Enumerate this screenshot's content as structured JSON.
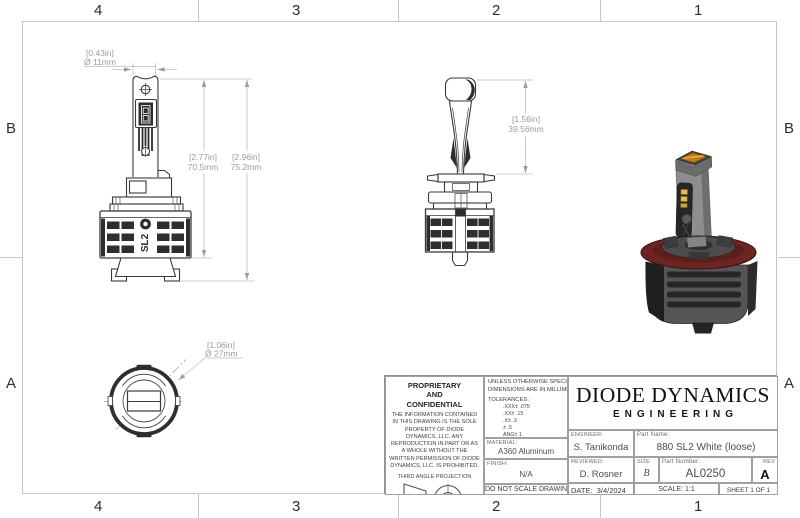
{
  "sheet": {
    "zones_top": [
      "4",
      "3",
      "2",
      "1"
    ],
    "zones_bottom": [
      "4",
      "3",
      "2",
      "1"
    ],
    "zones_left": [
      "B",
      "A"
    ],
    "zones_right": [
      "B",
      "A"
    ]
  },
  "views": {
    "front": {
      "dim_width_in": "[0.43in]",
      "dim_width_mm": "Ø 11mm",
      "dim_body_in": "[2.77in]",
      "dim_body_mm": "70.5mm",
      "dim_total_in": "[2.96in]",
      "dim_total_mm": "75.2mm",
      "heatsink_logo": "SL2"
    },
    "side": {
      "dim_height_in": "[1.56in]",
      "dim_height_mm": "39.56mm"
    },
    "bottom": {
      "dim_dia_in": "[1.06in]",
      "dim_dia_mm": "Ø 27mm"
    }
  },
  "title_block": {
    "proprietary": {
      "line1": "PROPRIETARY",
      "line2": "AND",
      "line3": "CONFIDENTIAL",
      "body": "THE INFORMATION CONTAINED IN THIS DRAWING IS THE SOLE PROPERTY OF DIODE DYNAMICS, LLC.  ANY REPRODUCTION IN PART OR AS A WHOLE WITHOUT THE WRITTEN PERMISSION OF DIODE DYNAMICS, LLC. IS PROHIBITED.",
      "projection_label": "THIRD ANGLE PROJECTION"
    },
    "specs": {
      "unless": "UNLESS OTHERWISE SPECIFIED:",
      "units": "DIMENSIONS ARE IN MILLIMETERS",
      "tolerances_label": "TOLERANCES:",
      "tolerances": [
        ".XXX± .075",
        ".XX± .15",
        ".X± .3",
        "± .5",
        "ANG± 1"
      ],
      "material_label": "MATERIAL:",
      "material": "A360 Aluminum",
      "finish_label": "FINISH:",
      "finish": "N/A",
      "do_not_scale": "DO NOT SCALE DRAWING"
    },
    "company": {
      "name": "DIODE DYNAMICS",
      "division": "ENGINEERING"
    },
    "fields": {
      "engineer_label": "ENGINEER:",
      "engineer": "S. Tanikonda",
      "part_name_label": "Part Name:",
      "part_name": "880 SL2 White (loose)",
      "reviewed_label": "REVIEWED:",
      "reviewed": "D. Rosner",
      "size_label": "SIZE",
      "size": "B",
      "part_number_label": "Part Number:",
      "part_number": "AL0250",
      "rev_label": "REV",
      "rev": "A",
      "date_label": "DATE:",
      "date": "3/4/2024",
      "scale": "SCALE: 1:1",
      "sheet": "SHEET 1 OF 1"
    }
  },
  "colors": {
    "gasket_red": "#6d2522",
    "emitter_amber": "#b8791f",
    "led_yellow": "#e0b84f",
    "outline_dark": "#3a3a3a",
    "dim_gray": "#9b9b9b"
  }
}
